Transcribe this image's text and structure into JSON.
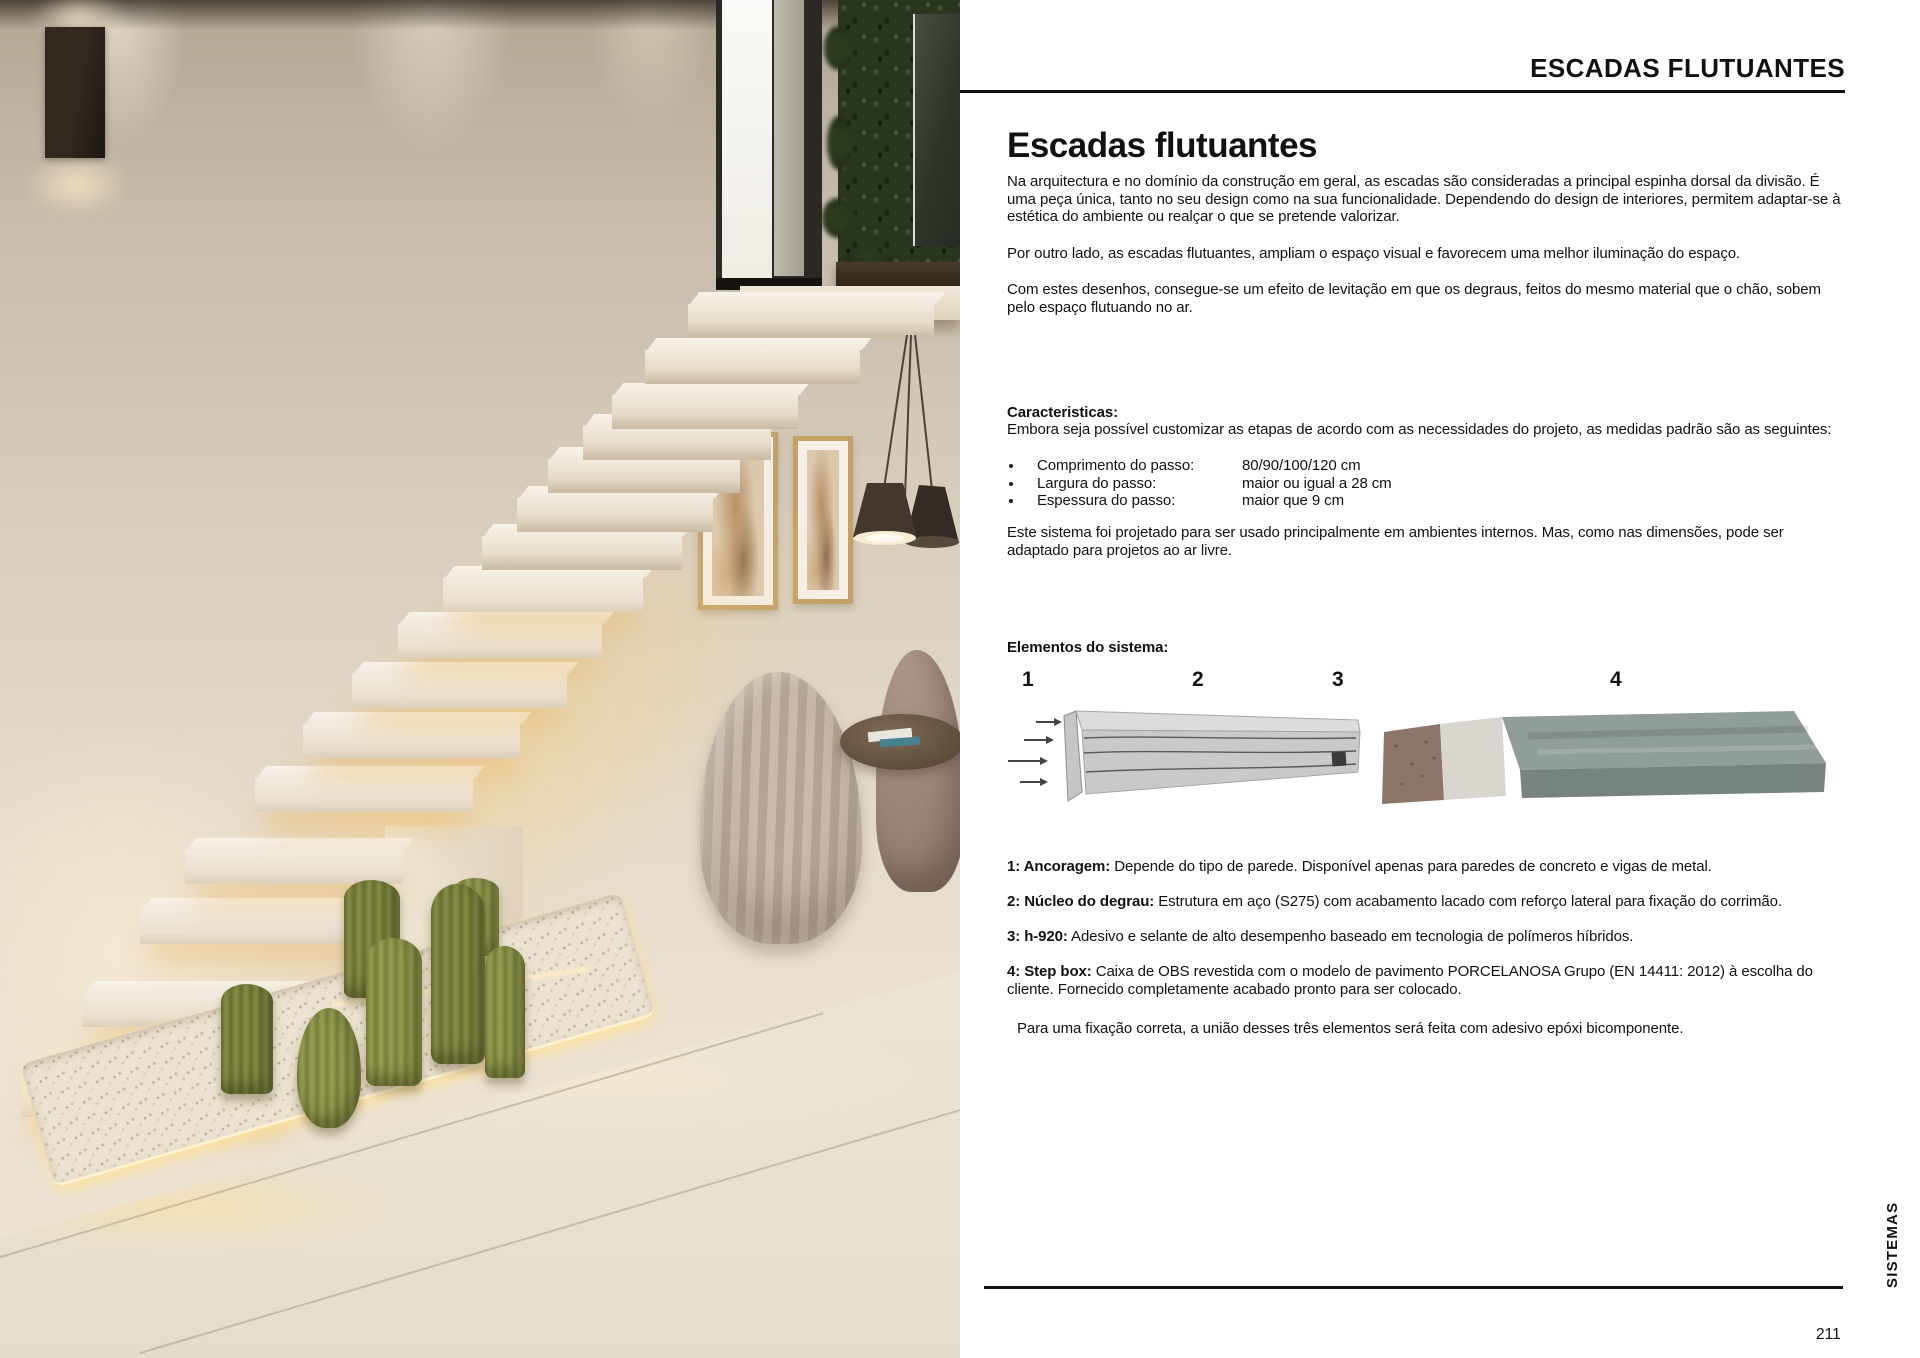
{
  "palette": {
    "text": "#111111",
    "rule": "#111111",
    "step_cream": "#f2ecdf",
    "glow_warm": "#f3d9a4",
    "cactus_green": "#7c8140",
    "plant_wall_green": "#2a3620",
    "steel_gray": "#c9c9c7",
    "osb_brown": "#8d7669",
    "tile_gray_green": "#919d98"
  },
  "header": {
    "title": "ESCADAS FLUTUANTES"
  },
  "footer": {
    "page_number": "211",
    "side_label": "SISTEMAS"
  },
  "photo": {
    "description": "floating cream stairs with cacti, vertical garden, pendant lamp and armchairs"
  },
  "article": {
    "title": "Escadas flutuantes",
    "paragraphs": [
      "Na arquitectura e no domínio da construção em geral, as escadas são consideradas a principal espinha dorsal da divisão. É uma peça única, tanto no seu design como na sua funcionalidade. Dependendo do design de interiores, permitem adaptar-se à estética do ambiente ou realçar o que se pretende valorizar.",
      "Por outro lado, as escadas flutuantes, ampliam o espaço visual e favorecem uma melhor iluminação do espaço.",
      "Com estes desenhos, consegue-se um efeito de levitação em que os degraus, feitos do mesmo material que o chão, sobem pelo espaço flutuando no ar."
    ],
    "characteristics": {
      "heading": "Caracteristicas:",
      "intro": "Embora seja possível customizar as etapas de acordo com as necessidades do projeto, as medidas padrão são as seguintes:",
      "items": [
        {
          "label": "Comprimento do passo:",
          "value": "80/90/100/120 cm"
        },
        {
          "label": "Largura do passo:",
          "value": "maior ou igual a 28 cm"
        },
        {
          "label": "Espessura do passo:",
          "value": "maior que 9 cm"
        }
      ],
      "note": "Este sistema foi projetado para ser usado principalmente em ambientes internos. Mas, como nas dimensões, pode ser adaptado para projetos ao ar livre."
    },
    "elements": {
      "heading": "Elementos do sistema:",
      "markers": [
        "1",
        "2",
        "3",
        "4"
      ],
      "items": [
        {
          "label": "1: Ancoragem:",
          "text": " Depende do tipo de parede. Disponível apenas para paredes de concreto e vigas de metal."
        },
        {
          "label": "2: Núcleo do degrau:",
          "text": " Estrutura em aço (S275) com acabamento lacado com reforço lateral para fixação do corrimão."
        },
        {
          "label": "3: h-920:",
          "text": " Adesivo e selante de alto desempenho baseado em tecnologia de polímeros híbridos."
        },
        {
          "label": "4: Step box:",
          "text": " Caixa de OBS revestida com o modelo de pavimento PORCELANOSA Grupo (EN 14411: 2012) à escolha do cliente. Fornecido completamente acabado pronto para ser colocado."
        }
      ],
      "footnote": "Para uma fixação correta, a união desses três elementos será feita com adesivo epóxi bicomponente."
    }
  }
}
